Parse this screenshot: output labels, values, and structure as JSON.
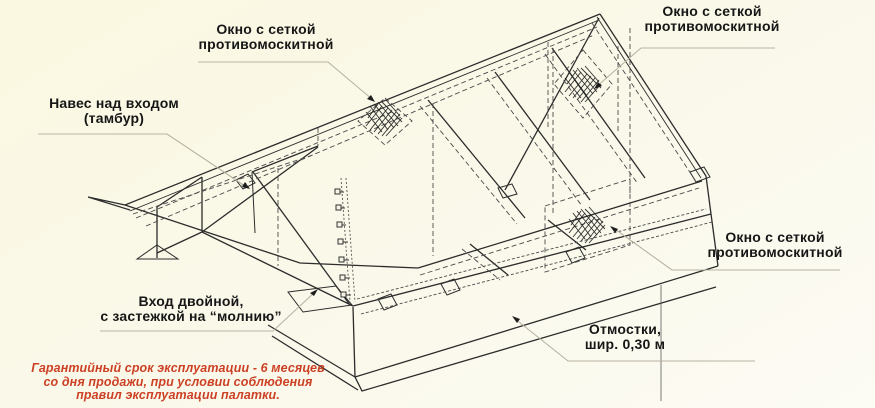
{
  "page": {
    "background_top": "#fbf8e1",
    "background_bottom": "#fcfbf4"
  },
  "drawing": {
    "line_color": "#2c2c2c",
    "dash_color": "#4a4a4a",
    "leader_color": "#b7b3a2",
    "icon": "mosquito-net-hatch"
  },
  "labels": {
    "window_tl": {
      "line1": "Окно с сеткой",
      "line2": "противомоскитной"
    },
    "window_tr": {
      "line1": "Окно с сеткой",
      "line2": "противомоскитной"
    },
    "canopy": {
      "line1": "Навес над входом",
      "line2": "(тамбур)"
    },
    "entrance": {
      "line1": "Вход двойной,",
      "line2": "с застежкой на “молнию”"
    },
    "window_right": {
      "line1": "Окно с сеткой",
      "line2": "противомоскитной"
    },
    "apron": {
      "line1": "Отмостки,",
      "line2": "шир. 0,30 м"
    }
  },
  "warranty": {
    "color": "#cc4125",
    "line1": "Гарантийный срок эксплуатации - 6 месяцев",
    "line2": "со дня продажи, при условии соблюдения",
    "line3": "правил эксплуатации палатки."
  }
}
